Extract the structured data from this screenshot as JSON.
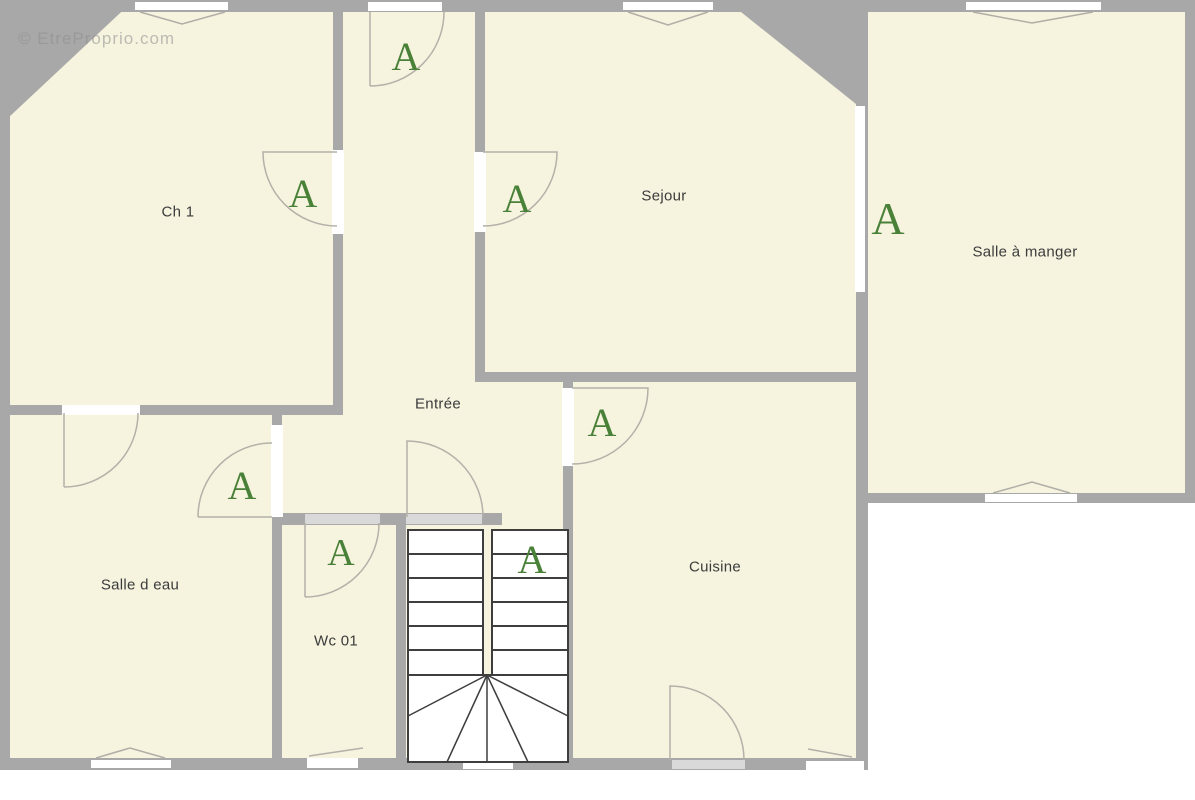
{
  "watermark": {
    "text": "© EtreProprio.com"
  },
  "plan": {
    "rooms": [
      {
        "id": "ch1",
        "label": "Ch 1"
      },
      {
        "id": "sejour",
        "label": "Sejour"
      },
      {
        "id": "salle_a_manger",
        "label": "Salle à manger"
      },
      {
        "id": "entree",
        "label": "Entrée"
      },
      {
        "id": "salle_d_eau",
        "label": "Salle d eau"
      },
      {
        "id": "wc01",
        "label": "Wc 01"
      },
      {
        "id": "cuisine",
        "label": "Cuisine"
      }
    ],
    "door_markers": [
      {
        "at": "ch1-door",
        "label": "A"
      },
      {
        "at": "hallway-top-door",
        "label": "A"
      },
      {
        "at": "sejour-door",
        "label": "A"
      },
      {
        "at": "salle-a-manger-pass",
        "label": "A"
      },
      {
        "at": "cuisine-entree-door",
        "label": "A"
      },
      {
        "at": "salle-d-eau-door",
        "label": "A"
      },
      {
        "at": "wc01-door",
        "label": "A"
      },
      {
        "at": "stairs",
        "label": "A"
      }
    ]
  },
  "colors": {
    "floor": "#f6f3df",
    "wall": "#a8a8a8",
    "door_marker_green": "#4a8138",
    "stair_outline": "#3e3e3e",
    "label_text": "#3c3c3c",
    "outside": "#ffffff"
  }
}
